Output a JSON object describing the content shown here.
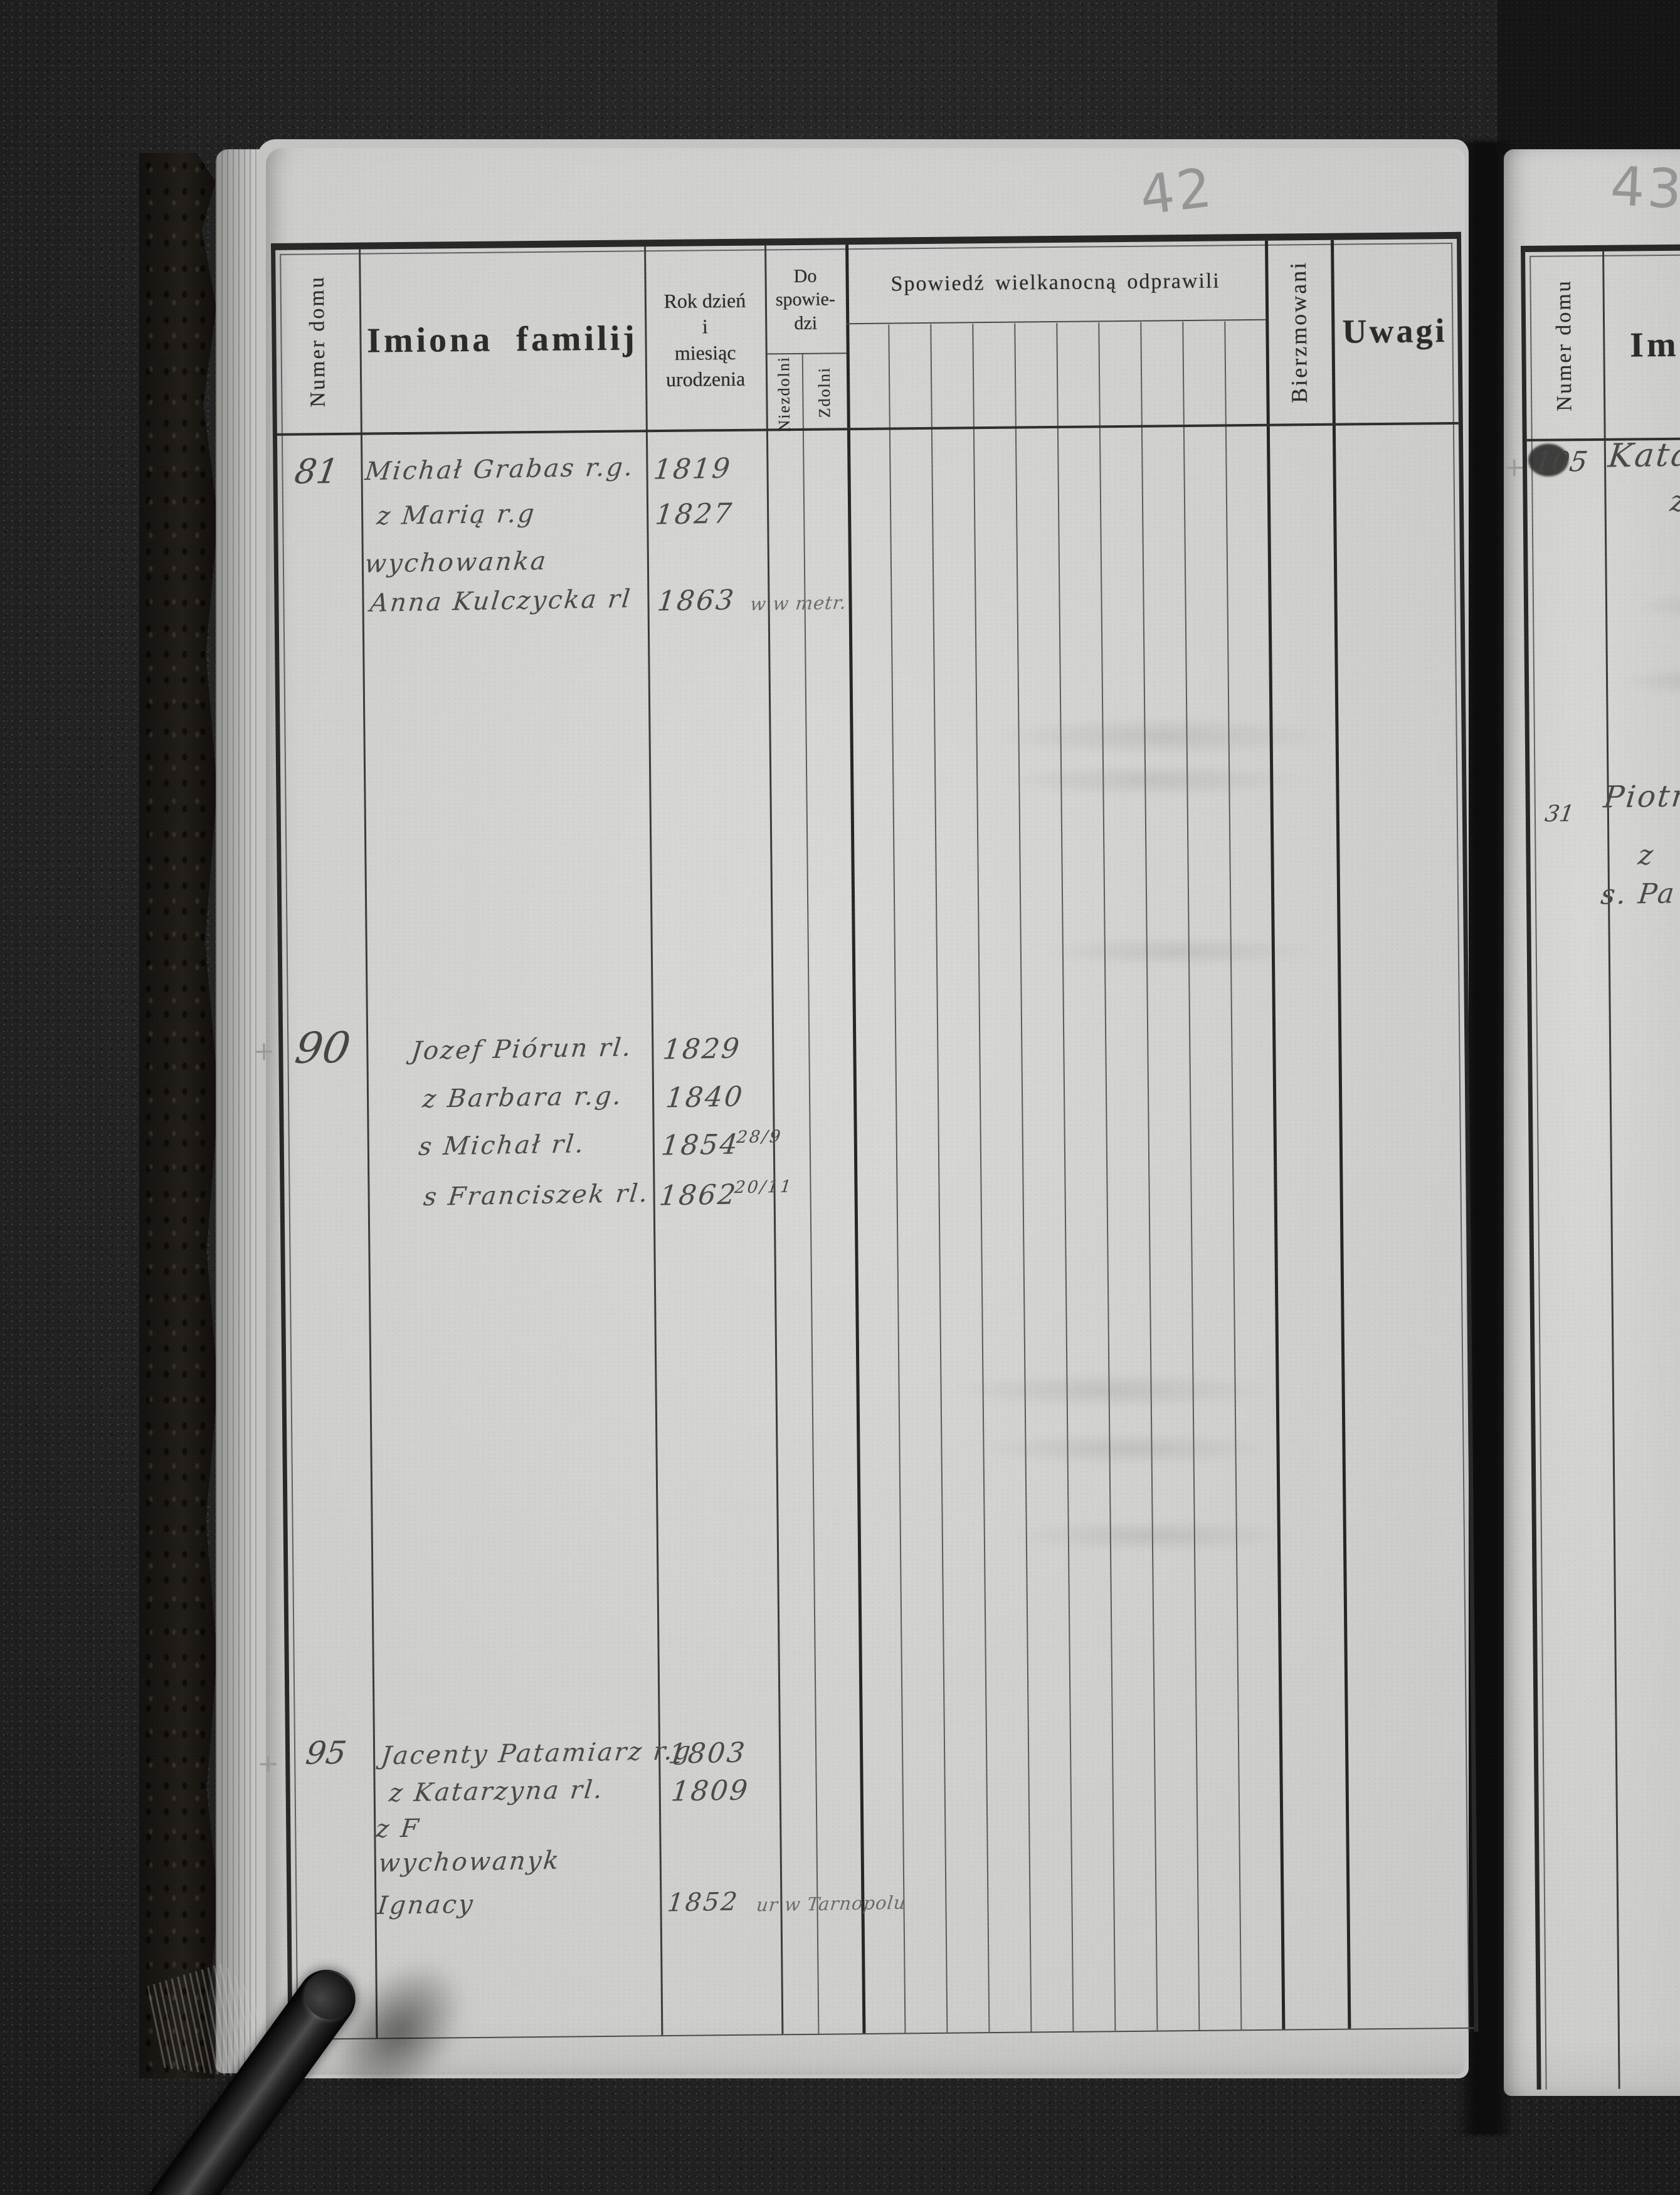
{
  "left_page": {
    "page_number": "42",
    "header": {
      "numer_domu": "Numer domu",
      "imiona_familij": "Imiona familij",
      "rok_l1": "Rok dzień",
      "rok_l2": "i",
      "rok_l3": "miesiąc",
      "rok_l4": "urodzenia",
      "do_l1": "Do",
      "do_l2": "spowie-",
      "do_l3": "dzi",
      "niezdolni": "Niezdolni",
      "zdolni": "Zdolni",
      "spowiedz": "Spowiedź wielkanocną odprawili",
      "bierzmowani": "Bierzmowani",
      "uwagi": "Uwagi"
    },
    "entries": [
      {
        "house_number": "81",
        "lines": [
          {
            "name": "Michał Grabas r.g.",
            "year": "1819"
          },
          {
            "name": "z Marią r.g",
            "year": "1827"
          },
          {
            "name": "wychowanka"
          },
          {
            "name": "Anna Kulczycka rl",
            "year": "1863",
            "note": "w w metr."
          }
        ]
      },
      {
        "house_number": "90",
        "margin_mark": "+",
        "lines": [
          {
            "name": "Jozef Piórun rl.",
            "year": "1829"
          },
          {
            "name": "z Barbara r.g.",
            "year": "1840"
          },
          {
            "name": "s Michał rl.",
            "year": "1854",
            "frac": "28/9"
          },
          {
            "name": "s Franciszek rl.",
            "year": "1862",
            "frac": "20/11"
          }
        ]
      },
      {
        "house_number": "95",
        "margin_mark": "+",
        "lines": [
          {
            "name": "Jacenty Patamiarz r.g",
            "year": "1803"
          },
          {
            "name": "z Katarzyna rl.",
            "year": "1809"
          },
          {
            "name": "z F"
          },
          {
            "name": "wychowanyk"
          },
          {
            "name": "Ignacy",
            "year": "1852",
            "note": "ur w Tarnopolu"
          }
        ]
      }
    ]
  },
  "right_page": {
    "page_number": "43",
    "header": {
      "numer_domu": "Numer domu",
      "imiona_fragment": "Im"
    },
    "entries": [
      {
        "house_number": "105",
        "margin_mark": "+",
        "lines": [
          {
            "name": "Katarz"
          },
          {
            "name": "z"
          }
        ]
      },
      {
        "house_number": "31",
        "lines": [
          {
            "name": "Piotr ż"
          },
          {
            "name": "z"
          },
          {
            "name": "s. Pa"
          }
        ]
      }
    ]
  }
}
